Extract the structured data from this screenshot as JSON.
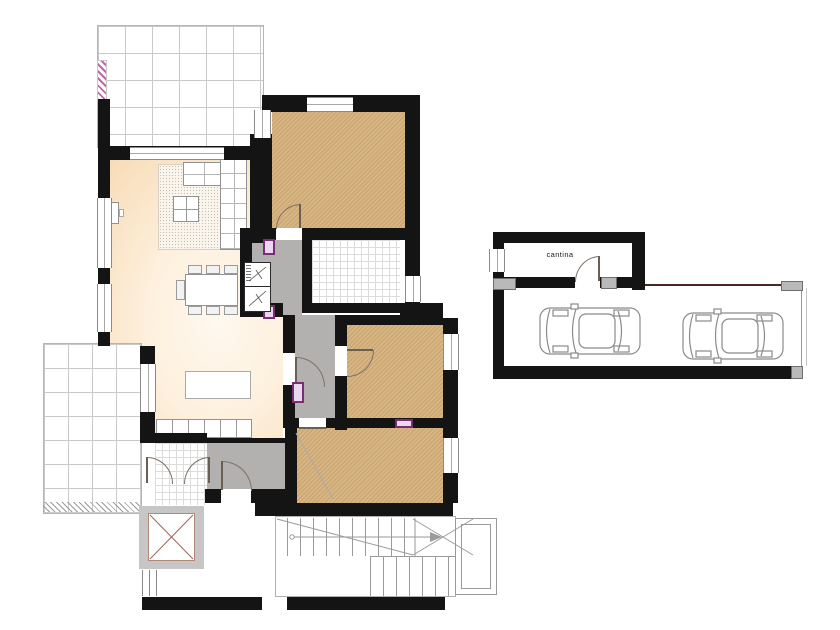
{
  "plan": {
    "type": "architectural-floor-plan",
    "labels": {
      "cantina": "cantina"
    },
    "colors": {
      "wall": "#141414",
      "bedroom_hatch_base": "#d7b685",
      "bedroom_hatch_stripe": "#c9a26c",
      "living_floor_peach": "#f8dcb8",
      "corridor_gray": "#b3b0b0",
      "terrace_grid": "#c9c9c9",
      "door_marker_purple": "#7b2d74",
      "railing_pink": "#c267a8",
      "elevator_cross": "#a2655c",
      "car_outline": "#8a8a8a",
      "carport_edge": "#4a2525"
    },
    "counts": {
      "cars": 2,
      "hatched_rooms": 3,
      "terraces": 2
    }
  }
}
